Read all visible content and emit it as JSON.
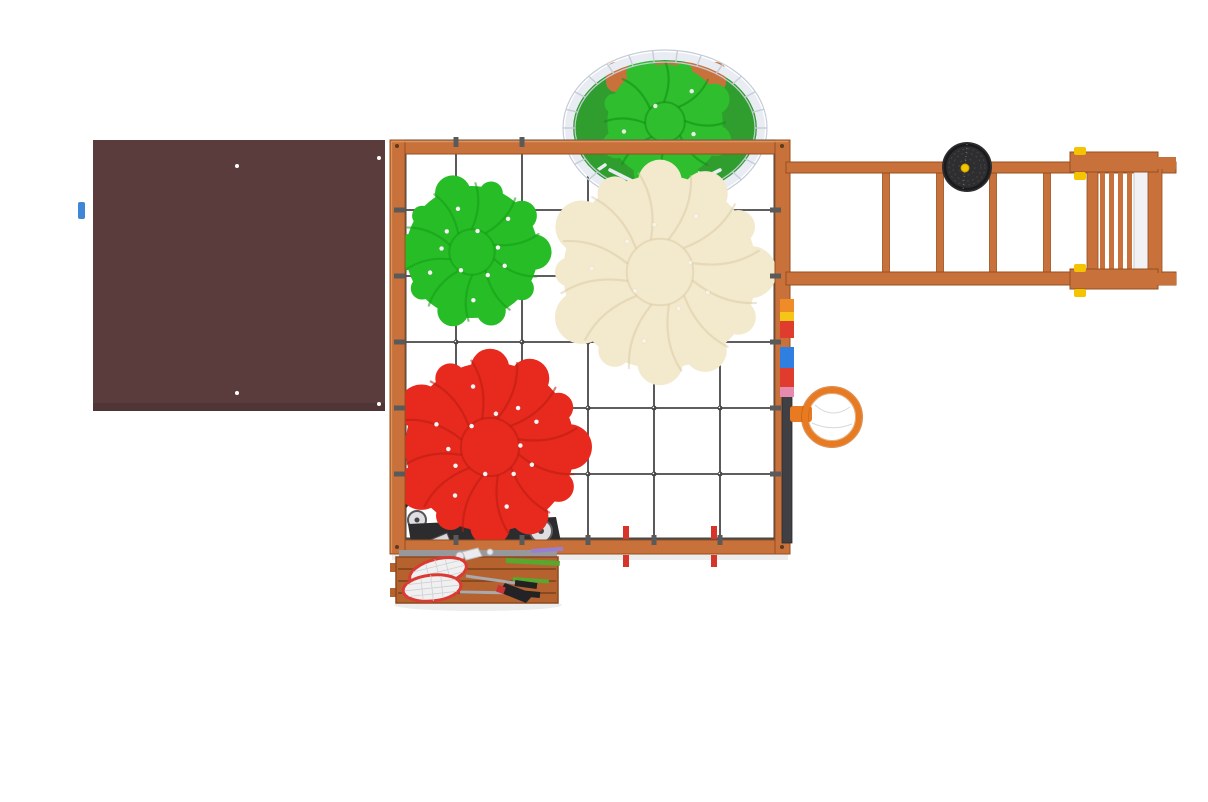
{
  "scene": {
    "description": "Top-down 3D render of a wooden children's playground complex on a white background",
    "background": "#ffffff"
  },
  "colors": {
    "wood": "#c8713b",
    "wood_dark": "#96501f",
    "wood_light": "#e09357",
    "roof": "#5a3c3d",
    "roof_screw": "#ffffff",
    "net": "#474747",
    "net_anchor": "#5a5a5a",
    "rope": "#e9ecf2",
    "rope_shade": "#c6ccd8",
    "basket_interior": "#2f9e2f",
    "nest_cushion": "#2ebe2e",
    "nest_cushion_dark": "#128c12",
    "cushion_green": "#26bd26",
    "cushion_green_dark": "#149d14",
    "cushion_cream": "#f3e9cd",
    "cushion_cream_dark": "#d8c69e",
    "cushion_red": "#e8291d",
    "cushion_red_dark": "#b51d12",
    "button_white": "#ffffff",
    "disc": "#2e2e30",
    "disc_detail": "#46464a",
    "clamp_yellow": "#f5c400",
    "hoop": "#e87a22",
    "hoop_dark": "#c05f10",
    "backboard": "#404044",
    "peg_red": "#d8352a",
    "panel_blocks": [
      "#f08c28",
      "#f5c518",
      "#e03c2d",
      "#2f7fe0",
      "#e03c2d",
      "#e78ab0"
    ],
    "bench": "#b5622f",
    "bench_dark": "#8a4a20",
    "scooter": "#2c2c2f",
    "wheel": "#dfdfe3",
    "wheel_rim": "#5a5a60",
    "racket_rim": "#d93b33",
    "racket_mesh": "#f0f0f0",
    "racket_shaft": "#a9a9ae",
    "racket_grip": "#222222",
    "tassel": "#232327",
    "rod_green": "#57a82e",
    "rod_purple": "#9a7fd0",
    "slide_white": "#f2f2f4",
    "blue_bit": "#3f86d6",
    "gray_strip": "#98989c",
    "shadow": "rgba(0,0,0,0.07)"
  },
  "objects": {
    "roof": "flat dark-brown roof panel seen from above with four screws",
    "climbing_net": "square wooden frame filled with a dark rope-net grid",
    "basket_swing": "white rope nest swing holding a green tufted cushion",
    "green_cushion": "small round green tufted cushion on the net",
    "cream_cushion": "large round cream tufted cushion on the net",
    "red_cushion": "round red tufted cushion lying over a scooter",
    "monkey_bars": "horizontal wooden ladder beam with four rungs",
    "disc_swing": "black round disc swing hanging from the beam",
    "end_ladder": "wooden end ladder with white slide edge and yellow clamps",
    "basketball_hoop": "orange basketball ring with dark backboard edge on the right rail",
    "color_panel": "stack of small colored blocks along the right rail",
    "swing_hooks": "two red mounting pegs on the bottom rail",
    "storage_bench": "wooden slatted bench with badminton rackets, shuttlecock and sticks",
    "scooter": "dark kick scooter parked under the red cushion"
  }
}
